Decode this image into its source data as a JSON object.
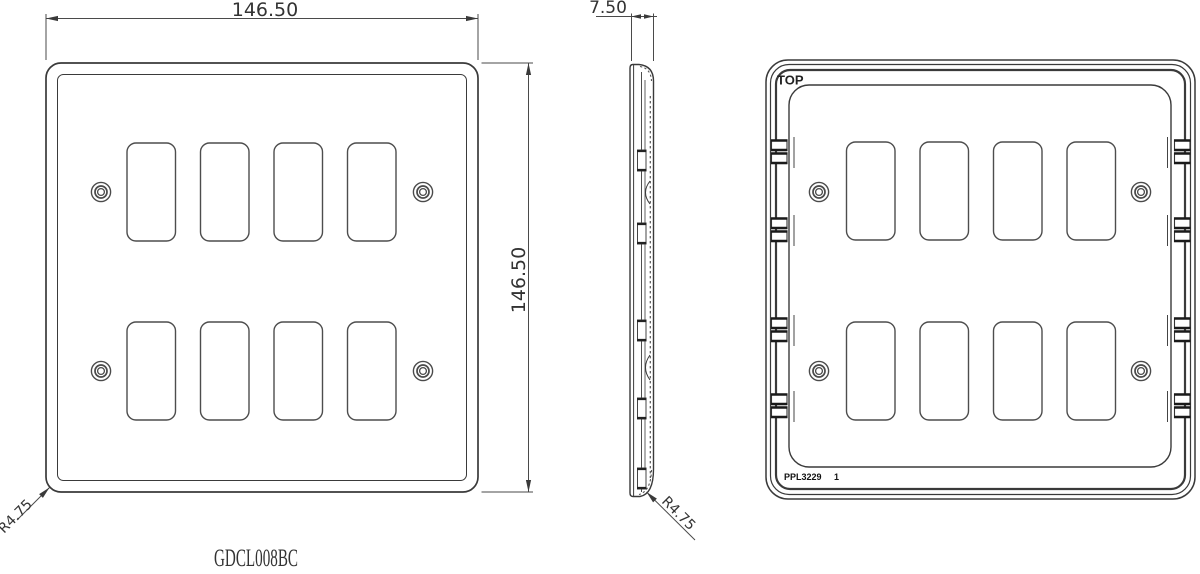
{
  "drawing": {
    "part_code": "GDCL008BC",
    "views": {
      "front": {
        "label_width": "146.50",
        "label_height": "146.50",
        "label_corner_radius": "R4.75"
      },
      "side": {
        "label_thickness": "7.50",
        "label_corner_radius": "R4.75"
      },
      "rear": {
        "label_top": "TOP",
        "label_mould": "PPL3229",
        "label_mould_sheet": "1"
      }
    },
    "colors": {
      "line": "#3a3a3a",
      "part_code": "#ff5555",
      "background": "#ffffff"
    }
  }
}
